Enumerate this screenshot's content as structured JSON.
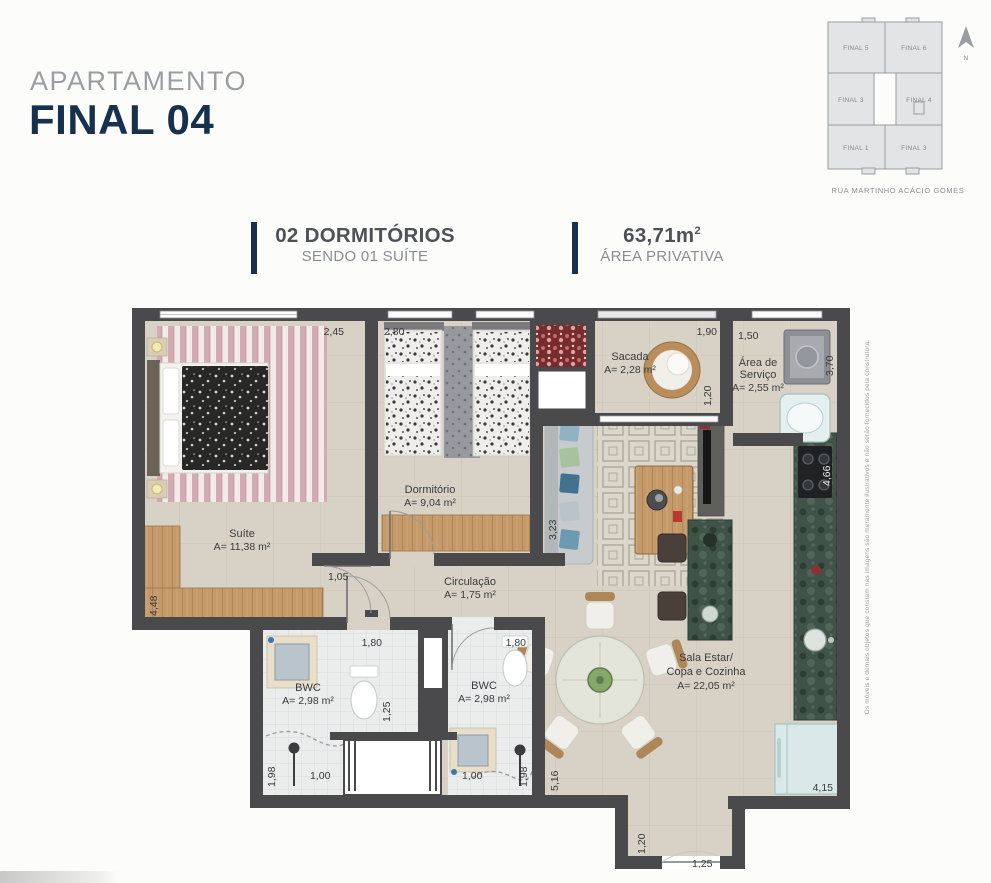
{
  "header": {
    "kicker": "APARTAMENTO",
    "title": "FINAL 04"
  },
  "key_plan": {
    "north": "N",
    "street": "RUA MARTINHO ACÁCIO GOMES",
    "units": [
      "FINAL 5",
      "FINAL 6",
      "FINAL 3",
      "FINAL 4",
      "FINAL 1",
      "FINAL 3"
    ]
  },
  "specs": {
    "bedrooms_title": "02 DORMITÓRIOS",
    "bedrooms_sub": "SENDO 01 SUÍTE",
    "area_value": "63,71m",
    "area_sup": "2",
    "area_sub": "ÁREA PRIVATIVA"
  },
  "plan": {
    "rooms": {
      "suite": {
        "name": "Suíte",
        "area": "A= 11,38 m²"
      },
      "dormitorio": {
        "name": "Dormitório",
        "area": "A= 9,04 m²"
      },
      "sacada": {
        "name": "Sacada",
        "area": "A= 2,28 m²"
      },
      "servico": {
        "l1": "Área de",
        "l2": "Serviço",
        "area": "A= 2,55 m²"
      },
      "circulacao": {
        "name": "Circulação",
        "area": "A= 1,75 m²"
      },
      "bwc1": {
        "name": "BWC",
        "area": "A= 2,98 m²"
      },
      "bwc2": {
        "name": "BWC",
        "area": "A= 2,98 m²"
      },
      "sala": {
        "l1": "Sala Estar/",
        "l2": "Copa e Cozinha",
        "area": "A= 22,05 m²"
      }
    },
    "dims": {
      "suite_w": "2,45",
      "dorm_w": "2,80",
      "sacada_w": "1,90",
      "servico_w": "1,50",
      "servico_h": "3,70",
      "sacada_d": "1,20",
      "sala_wall_h": "3,23",
      "circ_w": "1,05",
      "suite_h": "4,48",
      "cozinha_h": "4,66",
      "bwc1_w": "1,80",
      "bwc2_w": "1,80",
      "bwc_div": "1,25",
      "bwc1_h": "1,98",
      "bwc1_door": "1,00",
      "bwc2_door": "1,00",
      "bwc2_h": "1,98",
      "sala_h": "5,16",
      "entry_h": "1,20",
      "entry_door": "1,25",
      "sala_w": "4,15"
    }
  },
  "disclaimer": "Os móveis e demais objetos que constam nas imagens são meramente ilustrativos e não serão fornecidos pela construtora.",
  "colors": {
    "navy": "#17304e",
    "wall": "#4a4a4c",
    "floor": "#d8d2c6"
  }
}
